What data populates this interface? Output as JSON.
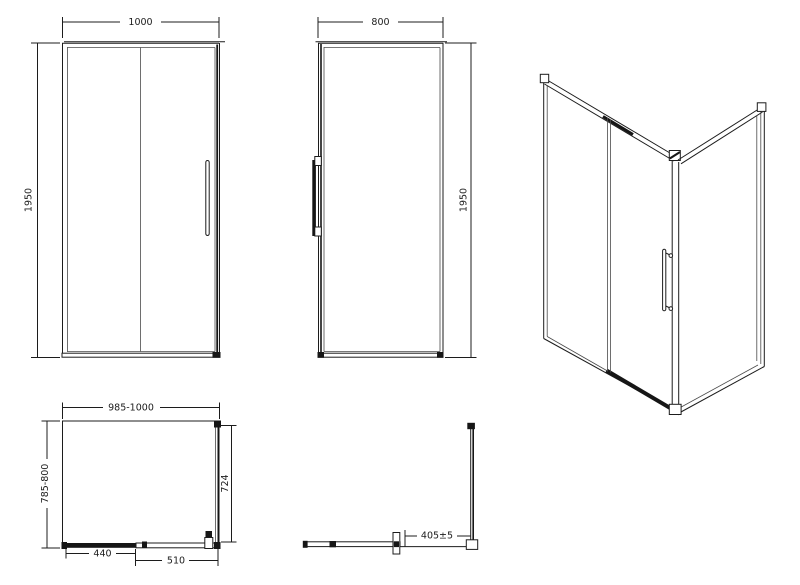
{
  "drawing": {
    "background_color": "#ffffff",
    "line_color": "#1c1c1c",
    "views": {
      "front": {
        "name": "front elevation",
        "dim_width": "1000",
        "dim_height": "1950"
      },
      "side": {
        "name": "side elevation",
        "dim_width": "800",
        "dim_height": "1950"
      },
      "perspective": {
        "name": "3d corner view"
      },
      "plan": {
        "name": "plan view",
        "dim_width": "985-1000",
        "dim_depth": "785-800",
        "dim_side_panel": "724",
        "dim_fixed_segment": "440",
        "dim_door_segment": "510"
      },
      "track_detail": {
        "name": "track plan detail",
        "dim_opening": "405±5"
      }
    }
  }
}
